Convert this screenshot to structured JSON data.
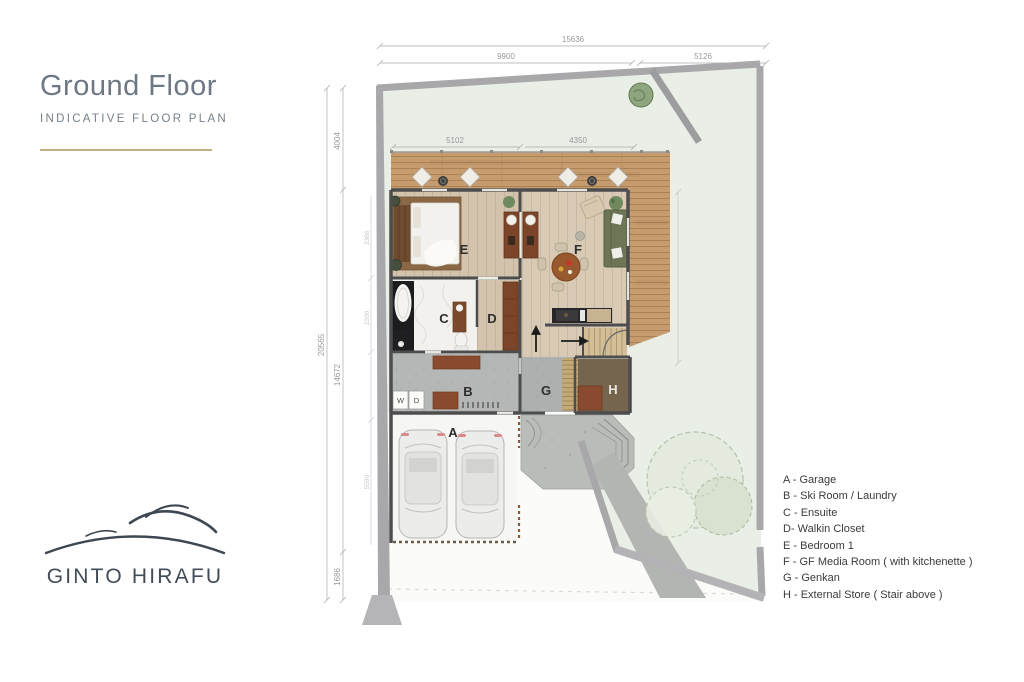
{
  "header": {
    "title": "Ground Floor",
    "subtitle": "INDICATIVE FLOOR PLAN"
  },
  "brand": {
    "name": "GINTO HIRAFU"
  },
  "legend": {
    "items": [
      "A - Garage",
      "B - Ski Room / Laundry",
      "C - Ensuite",
      "D- Walkin Closet",
      "E - Bedroom 1",
      "F - GF Media Room ( with kitchenette )",
      "G - Genkan",
      "H - External Store ( Stair above )"
    ]
  },
  "plan": {
    "rooms": {
      "a": "A",
      "b": "B",
      "c": "C",
      "d": "D",
      "e": "E",
      "f": "F",
      "g": "G",
      "h": "H",
      "washer": "W",
      "dryer": "D"
    },
    "dims": {
      "site_width_total": "15636",
      "site_width_left": "9900",
      "site_width_right": "5126",
      "deck_left": "5102",
      "deck_right": "4350",
      "site_height_total": "20565",
      "height_top": "4004",
      "height_mid": "14672",
      "height_bottom": "1686",
      "inner_a": "3386",
      "inner_b": "2200",
      "inner_c": "5590"
    }
  },
  "colors": {
    "accent_gold": "#c6ae83",
    "site_green": "#e9eee6",
    "deck_wood": "#c69c6e",
    "boundary_gray": "#a8a8aa",
    "wall_dark": "#4d4c4e",
    "title_gray": "#6e7884"
  }
}
